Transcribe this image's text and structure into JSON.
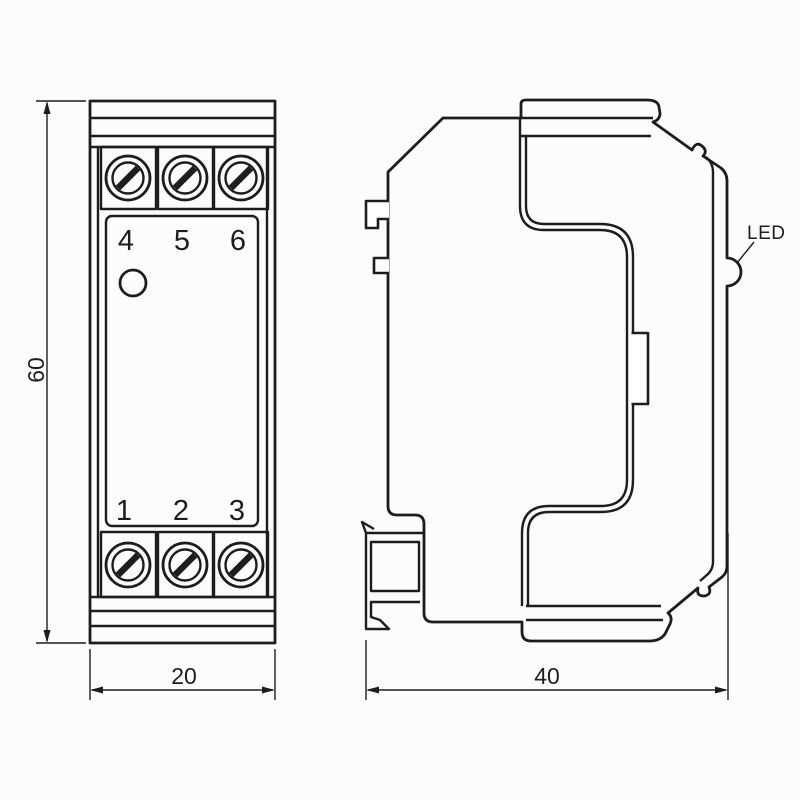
{
  "front_view": {
    "top_terminals": [
      "4",
      "5",
      "6"
    ],
    "bottom_terminals": [
      "1",
      "2",
      "3"
    ]
  },
  "side_view": {
    "led_label": "LED"
  },
  "dimensions": {
    "height": "60",
    "width": "20",
    "depth": "40"
  },
  "colors": {
    "line": "#1d1d1d",
    "background": "#fcfcfc"
  }
}
